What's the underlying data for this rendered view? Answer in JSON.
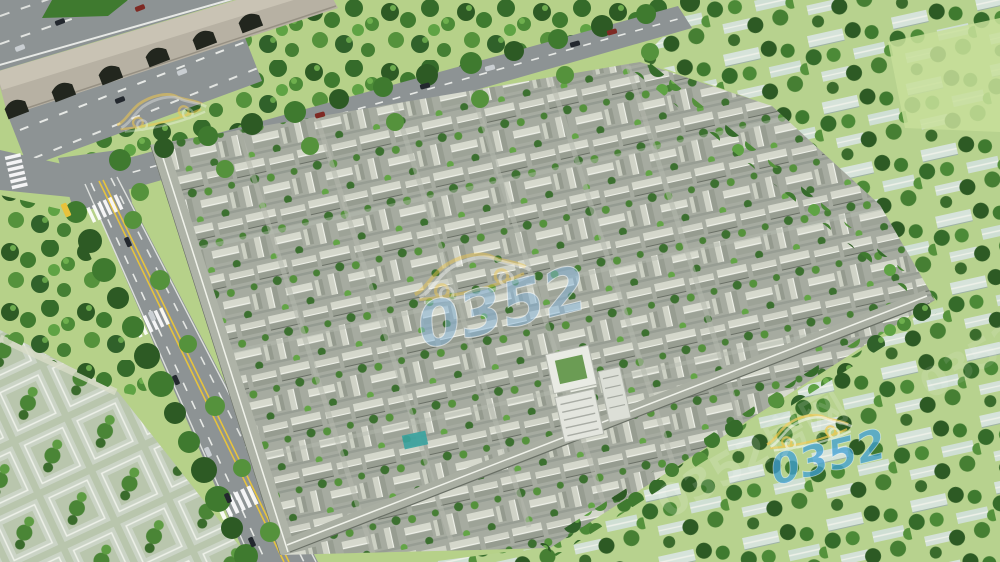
{
  "scene": {
    "description": "Aerial 3D architectural rendering of a large traditional Chinese courtyard-house (siheyuan) residential complex, bordered by a city wall with arched gates and a multi-lane highway at the top-left, tree-lined boulevards on the north and west sides, and low-rise tree-filled neighborhoods on the right and bottom-left.",
    "watermark": {
      "logo_text": "0352",
      "site_text": "0352房网"
    },
    "palette": {
      "grass": "#b6d189",
      "grass_light": "#c8df9a",
      "road": "#8d9394",
      "road_dark": "#7c8384",
      "lane_white": "#f1f3ef",
      "lane_yellow": "#e6c33d",
      "wall": "#b7b1a3",
      "wall_light": "#c9c3b4",
      "arch": "#22261e",
      "complex_ground": "#a6aba0",
      "roof_light": "#d4d7cb",
      "roof_dark": "#989e92",
      "roof_ridge": "#f0f2ea",
      "roof_edge": "#6a7066",
      "roof_teal": "#d6e3da",
      "pale_row": "#cbd4c6",
      "pale_ridge": "#eef1e9",
      "tree_dark": "#2d5a24",
      "tree_mid": "#3f7a2f",
      "tree_light": "#55923c",
      "tree_bright": "#6fb24f",
      "building_white": "#e9ebe4",
      "pool_teal": "#3aa3a0",
      "car_dark": "#23282e",
      "car_red": "#7e2a24",
      "car_silver": "#c9ced2",
      "bus_yellow": "#e8c23c",
      "watermark_blue": "#3f9fd4",
      "watermark_yellow": "#f2c84c",
      "watermark_white": "#ffffff"
    }
  }
}
